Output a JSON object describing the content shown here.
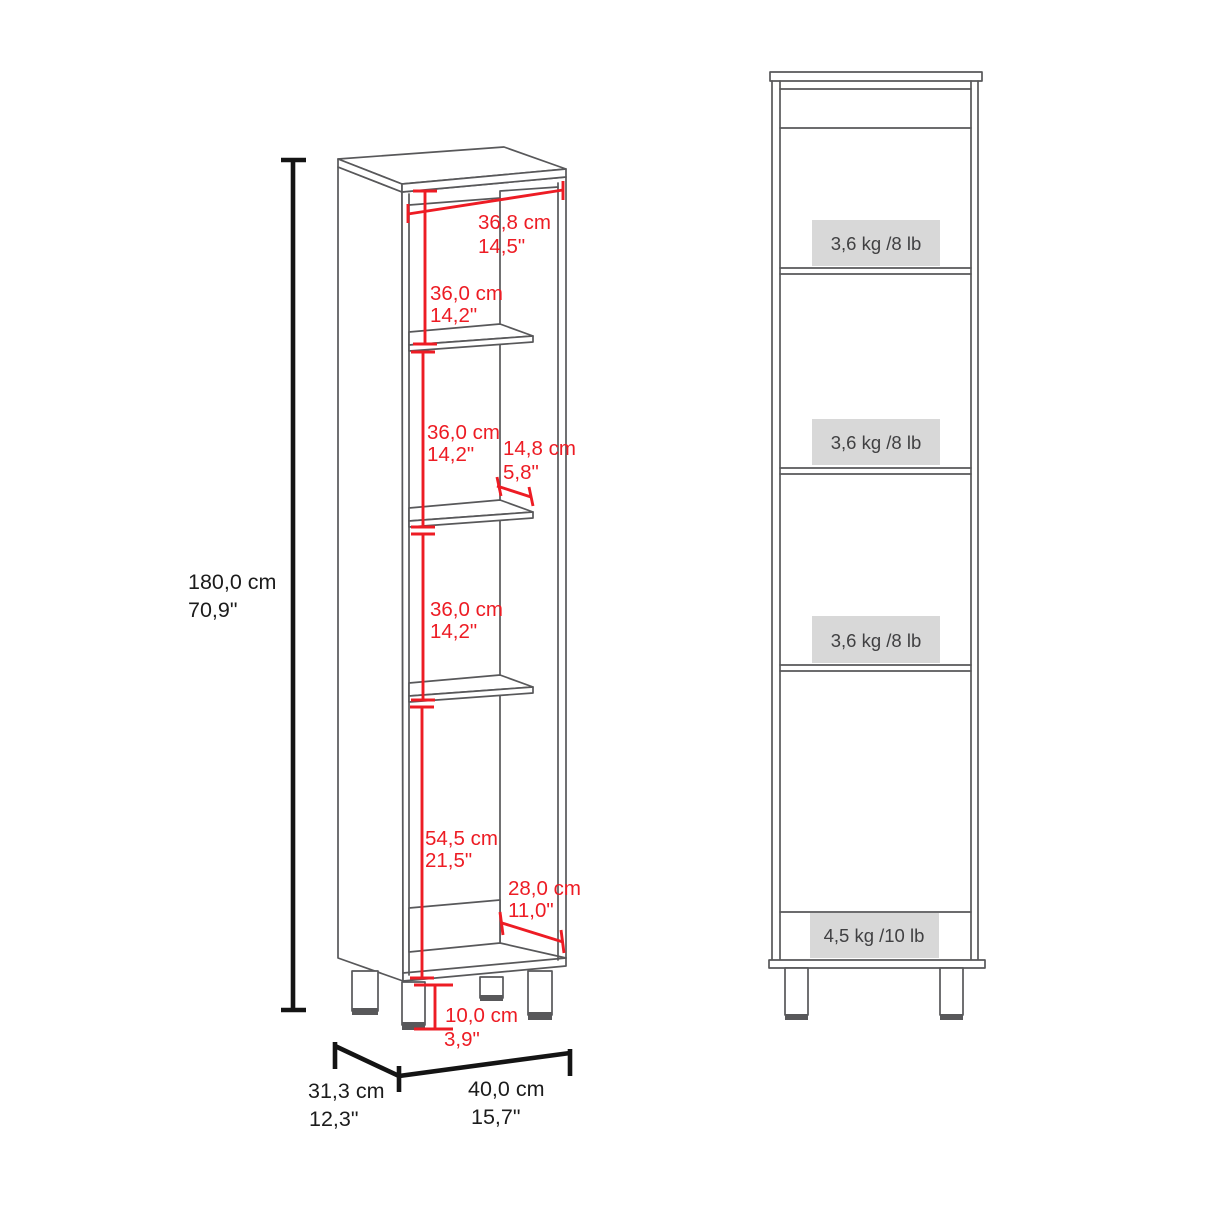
{
  "diagram_title": "cabinet-dimensions-diagram",
  "dimensions": {
    "total_height": {
      "cm": "180,0 cm",
      "inch": "70,9\""
    },
    "interior_width": {
      "cm": "36,8 cm",
      "inch": "14,5\""
    },
    "top_section_height": {
      "cm": "36,0 cm",
      "inch": "14,2\""
    },
    "middle_section_height": {
      "cm": "36,0 cm",
      "inch": "14,2\""
    },
    "shelf_depth": {
      "cm": "14,8 cm",
      "inch": "5,8\""
    },
    "lower_section_height": {
      "cm": "36,0 cm",
      "inch": "14,2\""
    },
    "bottom_section_height": {
      "cm": "54,5 cm",
      "inch": "21,5\""
    },
    "bottom_depth": {
      "cm": "28,0 cm",
      "inch": "11,0\""
    },
    "leg_height": {
      "cm": "10,0 cm",
      "inch": "3,9\""
    },
    "depth": {
      "cm": "31,3 cm",
      "inch": "12,3\""
    },
    "width": {
      "cm": "40,0 cm",
      "inch": "15,7\""
    }
  },
  "capacities": {
    "shelf_top": "3,6 kg /8 lb",
    "shelf_middle": "3,6 kg /8 lb",
    "shelf_lower": "3,6 kg /8 lb",
    "bottom": "4,5 kg /10 lb"
  },
  "colors": {
    "dimension_red": "#ed1c24",
    "outline_gray": "#58585a",
    "dimension_black": "#141414",
    "capacity_box_gray": "#d8d8d8",
    "capacity_text": "#404042"
  }
}
